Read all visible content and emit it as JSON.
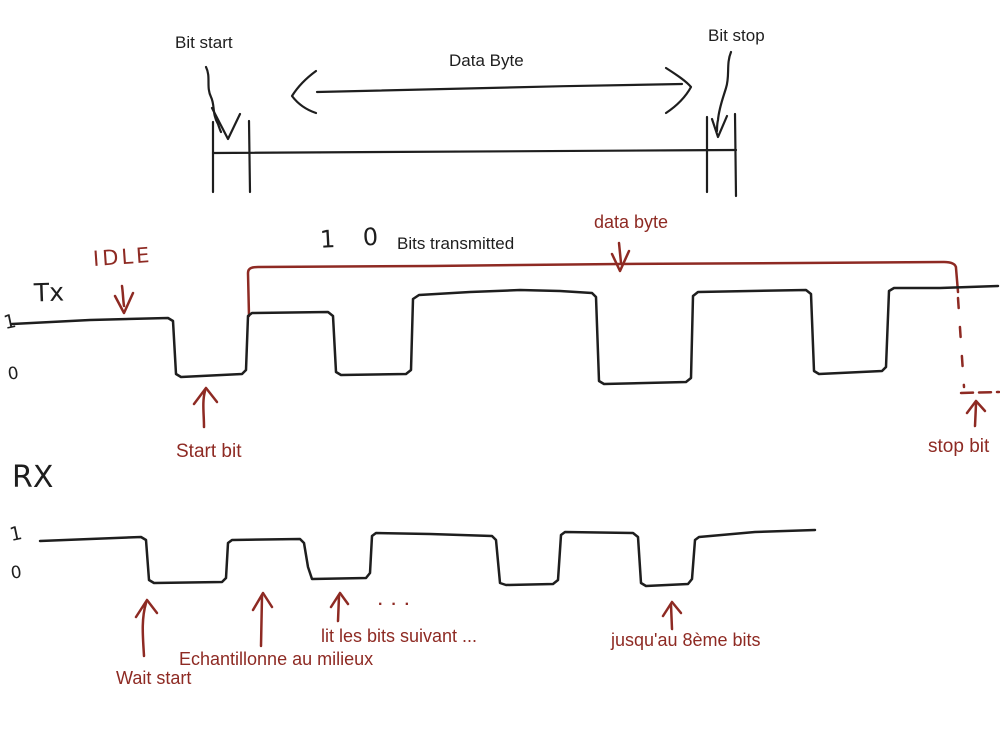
{
  "colors": {
    "background": "#ffffff",
    "ink": "#1e1e1e",
    "accent": "#8e2a23"
  },
  "top_diagram": {
    "bit_start": "Bit start",
    "data_byte": "Data Byte",
    "bit_stop": "Bit stop"
  },
  "tx": {
    "idle": "IDLE",
    "line_name": "Tx",
    "level_high": "1",
    "level_low": "0",
    "bits_count": "1 0",
    "bits_transmitted": "Bits transmitted",
    "data_byte": "data byte",
    "start_bit": "Start bit",
    "stop_bit": "stop bit",
    "waveform_points": [
      [
        12,
        324
      ],
      [
        90,
        320
      ],
      [
        168,
        318
      ],
      [
        173,
        321
      ],
      [
        176,
        374
      ],
      [
        181,
        377
      ],
      [
        242,
        374
      ],
      [
        246,
        370
      ],
      [
        248,
        316
      ],
      [
        252,
        313
      ],
      [
        328,
        312
      ],
      [
        333,
        316
      ],
      [
        336,
        372
      ],
      [
        341,
        375
      ],
      [
        406,
        374
      ],
      [
        411,
        370
      ],
      [
        413,
        299
      ],
      [
        419,
        295
      ],
      [
        470,
        292
      ],
      [
        520,
        290
      ],
      [
        560,
        291
      ],
      [
        592,
        293
      ],
      [
        596,
        297
      ],
      [
        599,
        381
      ],
      [
        604,
        384
      ],
      [
        686,
        382
      ],
      [
        691,
        378
      ],
      [
        693,
        296
      ],
      [
        698,
        292
      ],
      [
        750,
        291
      ],
      [
        806,
        290
      ],
      [
        811,
        294
      ],
      [
        814,
        371
      ],
      [
        819,
        374
      ],
      [
        882,
        371
      ],
      [
        886,
        367
      ],
      [
        889,
        291
      ],
      [
        894,
        288
      ],
      [
        940,
        288
      ],
      [
        998,
        286
      ]
    ]
  },
  "rx": {
    "line_name": "RX",
    "level_high": "1",
    "level_low": "0",
    "dots": ".  .  .",
    "wait_start": "Wait start",
    "sample_middle": "Echantillonne au milieux",
    "read_next": "lit les bits suivant ...",
    "until_8th": "jusqu'au 8ème bits",
    "waveform_points": [
      [
        40,
        541
      ],
      [
        90,
        539
      ],
      [
        141,
        537
      ],
      [
        146,
        540
      ],
      [
        149,
        580
      ],
      [
        154,
        583
      ],
      [
        222,
        582
      ],
      [
        226,
        578
      ],
      [
        228,
        543
      ],
      [
        232,
        540
      ],
      [
        300,
        539
      ],
      [
        304,
        543
      ],
      [
        308,
        567
      ],
      [
        312,
        579
      ],
      [
        366,
        578
      ],
      [
        370,
        573
      ],
      [
        372,
        536
      ],
      [
        376,
        533
      ],
      [
        430,
        534
      ],
      [
        492,
        536
      ],
      [
        496,
        540
      ],
      [
        500,
        583
      ],
      [
        506,
        585
      ],
      [
        553,
        584
      ],
      [
        558,
        580
      ],
      [
        561,
        535
      ],
      [
        565,
        532
      ],
      [
        633,
        533
      ],
      [
        638,
        537
      ],
      [
        641,
        583
      ],
      [
        646,
        586
      ],
      [
        688,
        584
      ],
      [
        692,
        579
      ],
      [
        695,
        540
      ],
      [
        699,
        537
      ],
      [
        755,
        532
      ],
      [
        815,
        530
      ]
    ]
  }
}
